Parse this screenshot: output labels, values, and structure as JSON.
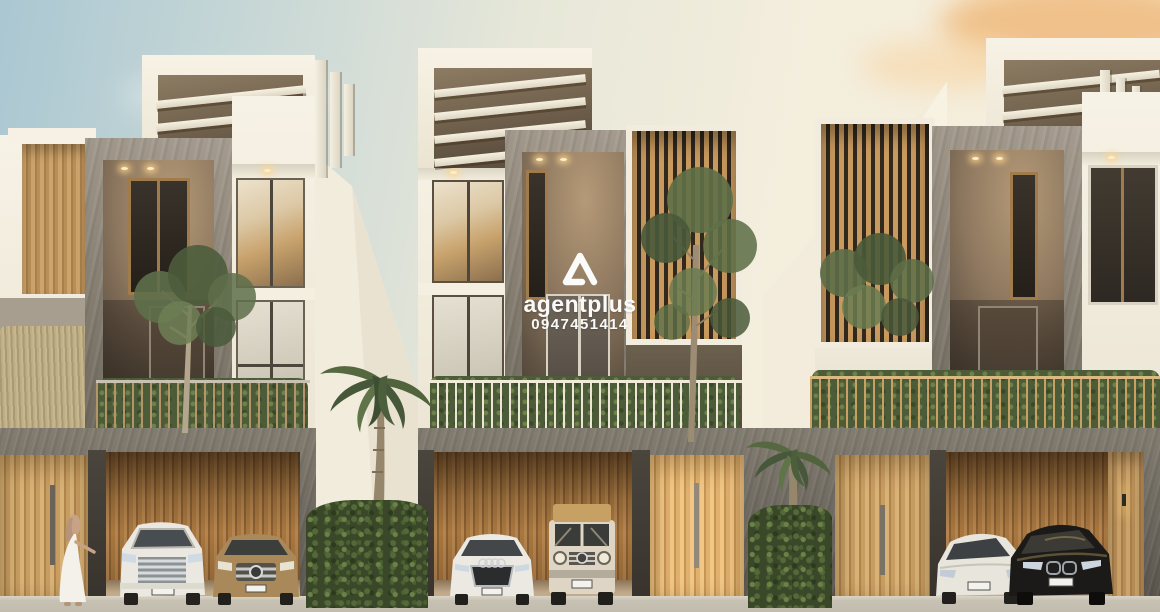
{
  "watermark": {
    "brand": "agentplus",
    "phone": "0947451414",
    "logo": "rounded-triangle"
  },
  "palette": {
    "sky_blue": "#aac7d2",
    "sky_cream": "#f6eeda",
    "cloud_orange": "#f2c286",
    "wall_white": "#f4efe3",
    "stone_grey": "#8a8275",
    "stone_dark": "#565249",
    "wood_light": "#cda46b",
    "wood_dark": "#8a5f33",
    "hedge_green": "#3a4829",
    "road_grey": "#c7c1b3",
    "watermark_white": "#ffffff"
  },
  "scene": {
    "subject": "row of three modern three-storey townhouses with garages",
    "units": [
      "left-townhouse",
      "middle-townhouse",
      "right-townhouse"
    ],
    "cars": [
      "white-minivan",
      "bronze-suv",
      "white-sedan",
      "cream-g-class-suv",
      "white-coupe",
      "black-sedan"
    ],
    "vegetation": [
      "palm-tree-left",
      "palm-tree-right",
      "hedge-left",
      "hedge-right",
      "tree-left-unit",
      "tree-middle-unit",
      "balcony-plants"
    ],
    "figures": [
      "woman-in-white-dress"
    ]
  }
}
